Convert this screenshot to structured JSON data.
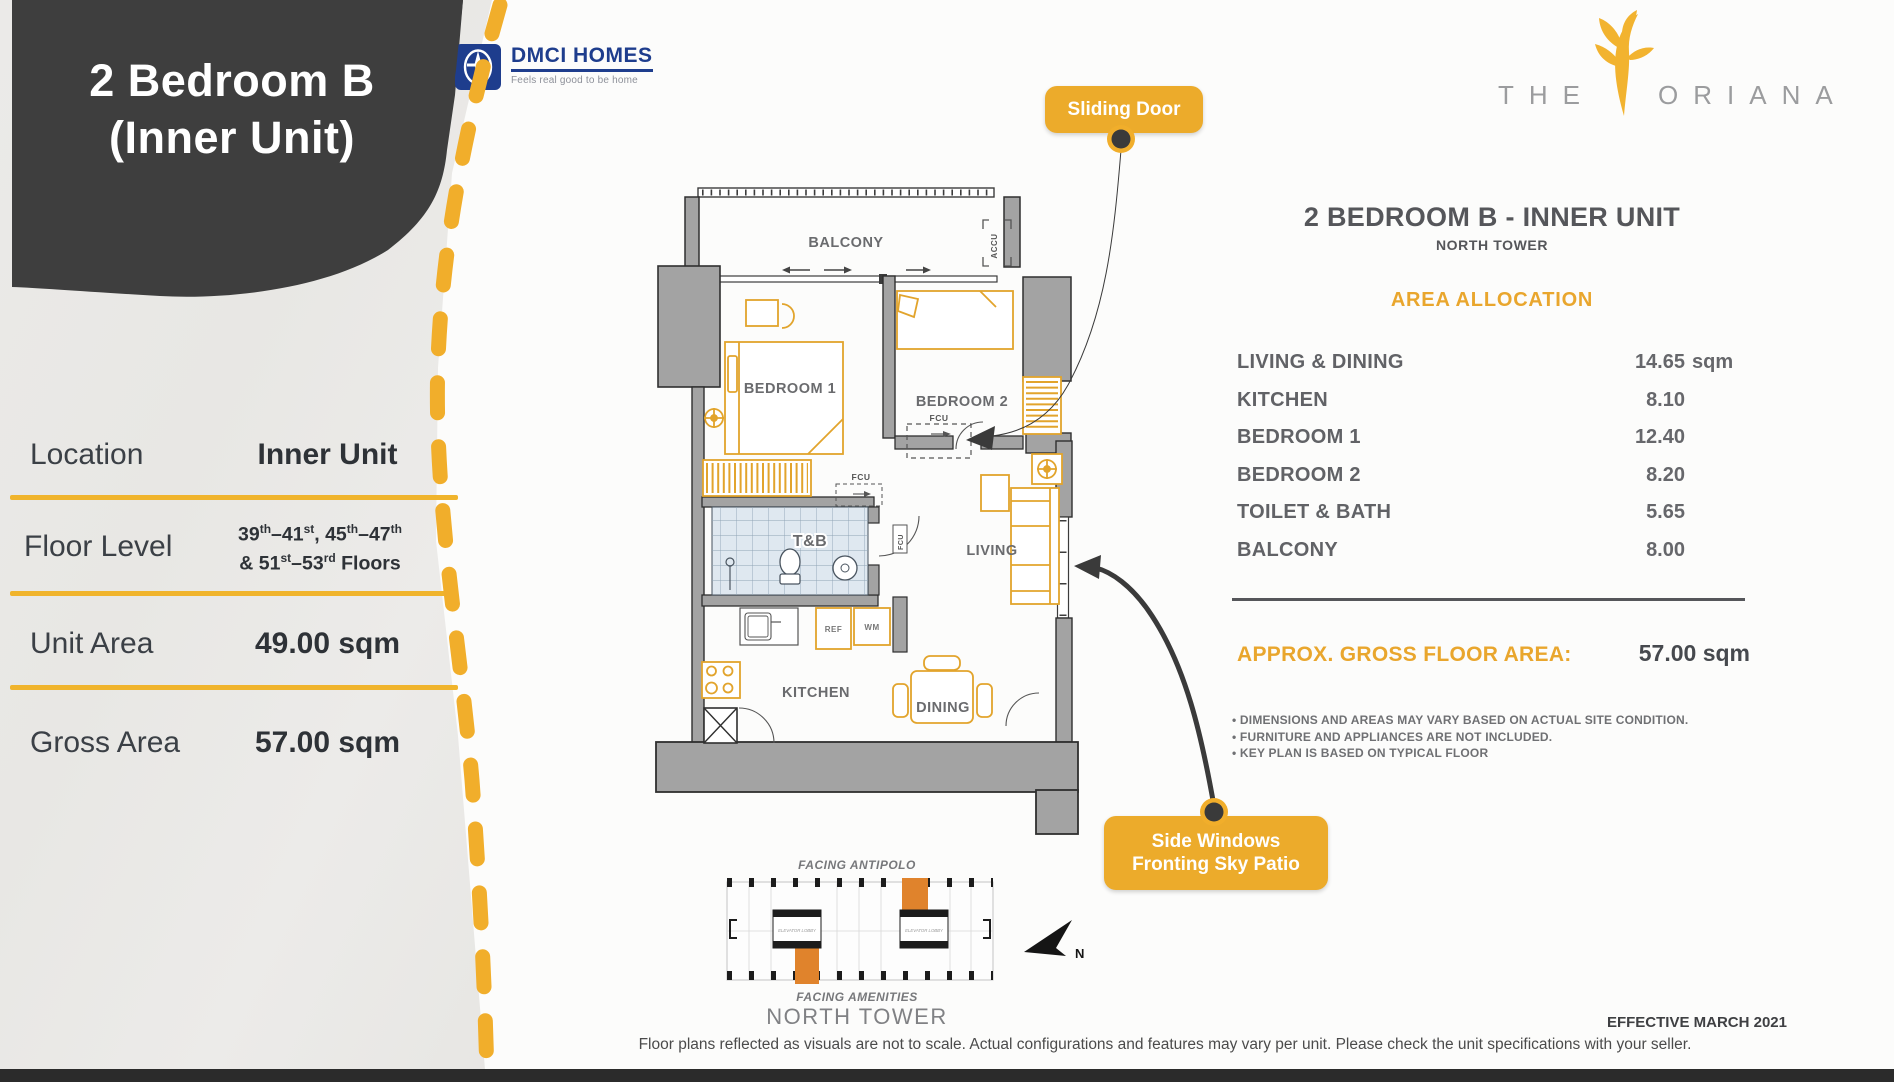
{
  "colors": {
    "gold": "#f0b42c",
    "dark_box": "#3e3e3e",
    "text_gray": "#55565a",
    "dmci_blue": "#1e3d8d",
    "keyplan_orange": "#e0832c",
    "footer_bar": "#2b2b2b"
  },
  "left_panel": {
    "title_line1": "2 Bedroom B",
    "title_line2": "(Inner Unit)",
    "location_label": "Location",
    "location_value": "Inner Unit",
    "floor_label": "Floor Level",
    "floor_value_line1": "39^th^–41^st^, 45^th^–47^th^",
    "floor_value_line2": "& 51^st^–53^rd^ Floors",
    "unit_area_label": "Unit Area",
    "unit_area_value": "49.00 sqm",
    "gross_area_label": "Gross Area",
    "gross_area_value": "57.00 sqm"
  },
  "branding": {
    "dmci": {
      "name": "DMCI HOMES",
      "tagline": "Feels real good to be home"
    },
    "oriana": {
      "word1": "THE",
      "word2": "ORIANA"
    }
  },
  "callouts": {
    "sliding_door": "Sliding Door",
    "side_windows_line1": "Side Windows",
    "side_windows_line2": "Fronting Sky Patio"
  },
  "floor_plan": {
    "labels": {
      "balcony": "BALCONY",
      "bedroom1": "BEDROOM 1",
      "bedroom2": "BEDROOM 2",
      "tnb": "T&B",
      "living": "LIVING",
      "kitchen": "KITCHEN",
      "dining": "DINING",
      "ref": "REF",
      "wm": "WM",
      "accu": "ACCU",
      "fcu": "FCU"
    }
  },
  "details": {
    "title": "2 BEDROOM B - INNER UNIT",
    "subtitle": "NORTH TOWER",
    "section_heading": "AREA ALLOCATION",
    "areas": [
      {
        "label": "LIVING & DINING",
        "value": "14.65",
        "unit": "sqm"
      },
      {
        "label": "KITCHEN",
        "value": "8.10",
        "unit": ""
      },
      {
        "label": "BEDROOM 1",
        "value": "12.40",
        "unit": ""
      },
      {
        "label": "BEDROOM 2",
        "value": "8.20",
        "unit": ""
      },
      {
        "label": "TOILET & BATH",
        "value": "5.65",
        "unit": ""
      },
      {
        "label": "BALCONY",
        "value": "8.00",
        "unit": ""
      }
    ],
    "gross_label": "APPROX. GROSS FLOOR AREA:",
    "gross_value": "57.00 sqm",
    "notes": [
      "• DIMENSIONS AND AREAS MAY VARY BASED ON ACTUAL SITE CONDITION.",
      "• FURNITURE AND APPLIANCES ARE NOT INCLUDED.",
      "• KEY PLAN IS BASED ON TYPICAL FLOOR"
    ]
  },
  "keyplan": {
    "facing_top": "FACING ANTIPOLO",
    "facing_bottom": "FACING AMENITIES",
    "tower": "NORTH TOWER",
    "elevator": "ELEVATOR LOBBY",
    "north": "N"
  },
  "footer": {
    "effective": "EFFECTIVE MARCH 2021",
    "disclaimer": "Floor plans reflected as visuals are not to scale. Actual configurations and features may vary per unit. Please check the unit specifications with your seller."
  }
}
